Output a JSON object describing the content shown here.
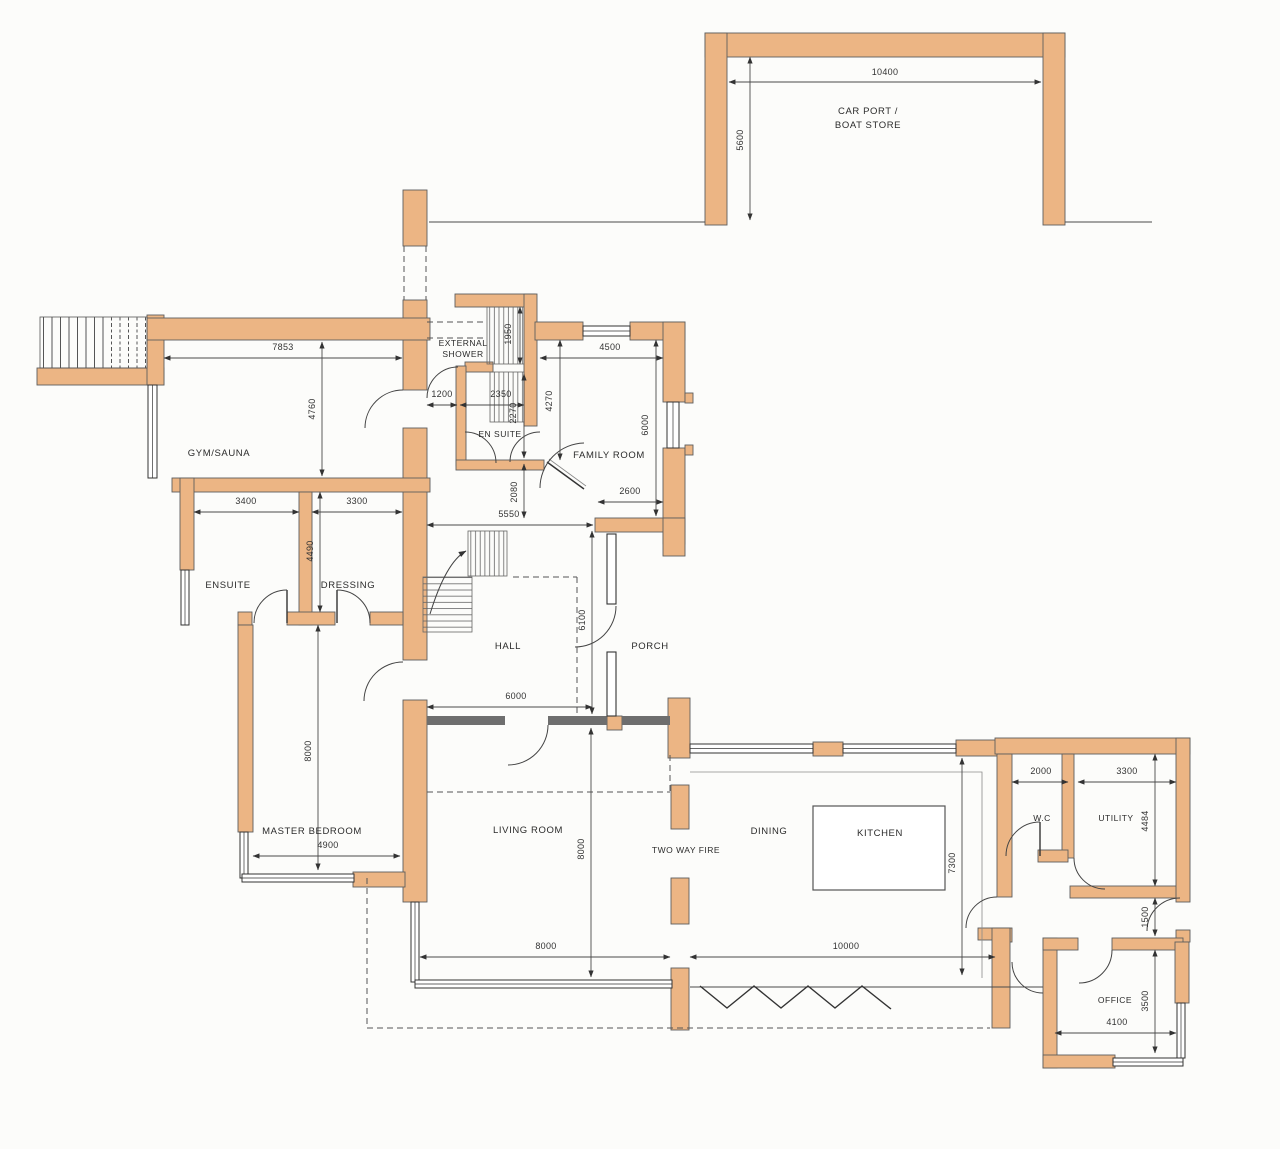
{
  "colors": {
    "wall_fill": "#ecb584",
    "wall_outline": "#6b6b6b",
    "line": "#3c3c3c",
    "background": "#fcfcfa"
  },
  "rooms": {
    "car_port": {
      "line1": "CAR PORT /",
      "line2": "BOAT STORE"
    },
    "external_shower": {
      "line1": "EXTERNAL",
      "line2": "SHOWER"
    },
    "gym_sauna": {
      "label": "GYM/SAUNA"
    },
    "en_suite": {
      "label": "EN SUITE"
    },
    "family_room": {
      "label": "FAMILY ROOM"
    },
    "ensuite": {
      "label": "ENSUITE"
    },
    "dressing": {
      "label": "DRESSING"
    },
    "hall": {
      "label": "HALL"
    },
    "porch": {
      "label": "PORCH"
    },
    "master_bedroom": {
      "label": "MASTER BEDROOM"
    },
    "living_room": {
      "label": "LIVING ROOM"
    },
    "two_way_fire": {
      "label": "TWO WAY FIRE"
    },
    "dining": {
      "label": "DINING"
    },
    "kitchen": {
      "label": "KITCHEN"
    },
    "wc": {
      "label": "W.C"
    },
    "utility": {
      "label": "UTILITY"
    },
    "office": {
      "label": "OFFICE"
    }
  },
  "dims": {
    "carport_width": "10400",
    "carport_depth": "5600",
    "gym_width": "7853",
    "gym_depth": "4760",
    "shower_passage": "1200",
    "stair_width": "2350",
    "stair_depth": "2270",
    "stair_flight": "1950",
    "family_width": "4500",
    "family_inner": "4270",
    "family_depth": "6000",
    "family_door": "2600",
    "ensuite_width": "3400",
    "dressing_width": "3300",
    "ensuite_depth": "4490",
    "hall_top": "5550",
    "hall_gap": "2080",
    "porch_depth": "6100",
    "hall_width": "6000",
    "master_depth": "8000",
    "master_width": "4900",
    "living_depth": "8000",
    "living_width": "8000",
    "dining_width": "10000",
    "kitchen_depth": "7300",
    "wc_width": "2000",
    "utility_width": "3300",
    "utility_depth": "4484",
    "corridor": "1500",
    "office_depth": "3500",
    "office_width": "4100"
  }
}
